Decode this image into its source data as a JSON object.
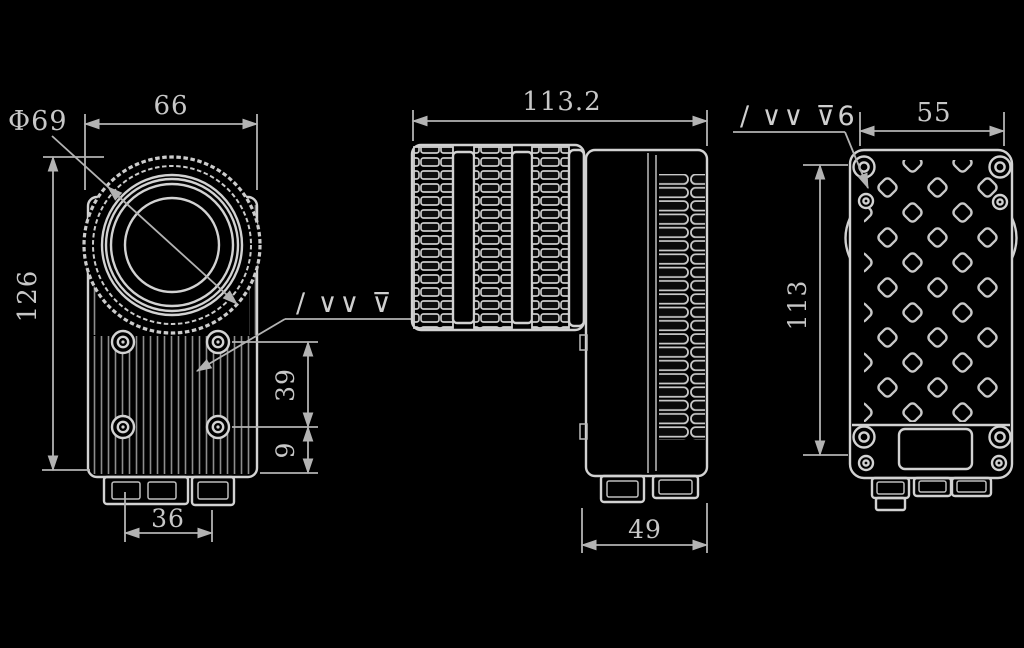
{
  "drawing": {
    "kind": "technical-drawing-three-views",
    "background": "#000000",
    "line_color": "#d2d2d2",
    "dimension_color": "#b3b3b3"
  },
  "views": {
    "front": {
      "name": "front-view",
      "labels": {
        "lens_diameter": "Φ69",
        "width": "66",
        "height": "126",
        "hole_row_spacing": "39",
        "hole_bottom_offset": "9",
        "mount_width": "36",
        "surface_finish": "∕ ∨∨ ⊽"
      }
    },
    "side": {
      "name": "side-view",
      "labels": {
        "overall_depth": "113.2",
        "body_depth": "49"
      }
    },
    "back": {
      "name": "back-view",
      "labels": {
        "width": "55",
        "height": "113",
        "surface_finish": "∕ ∨∨ ⊽6"
      }
    }
  }
}
